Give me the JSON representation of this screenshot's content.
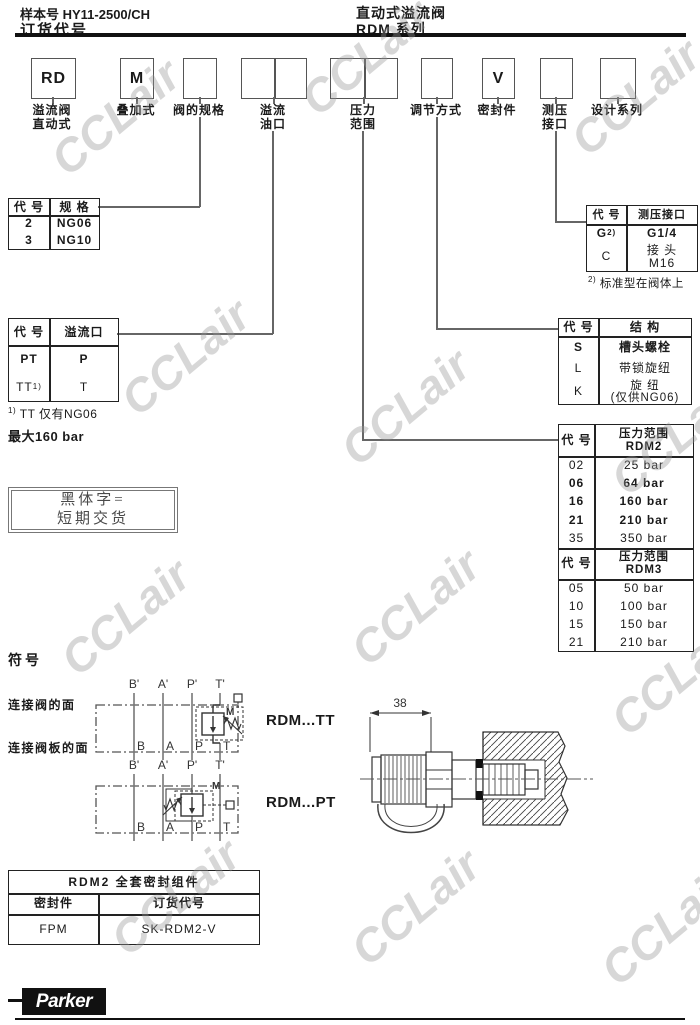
{
  "header": {
    "doc_no": "样本号 HY11-2500/CH",
    "title": "订货代号",
    "product": "直动式溢流阀",
    "series": "RDM  系列"
  },
  "watermark": {
    "text": "CCLair"
  },
  "order_code": {
    "items": [
      {
        "code": "RD",
        "line1": "溢流阀",
        "line2": "直动式"
      },
      {
        "code": "M",
        "line1": "叠加式",
        "line2": ""
      },
      {
        "code": "",
        "line1": "阀的规格",
        "line2": ""
      },
      {
        "code": "",
        "line1": "溢流",
        "line2": "油口"
      },
      {
        "code": "",
        "line1": "压力",
        "line2": "范围"
      },
      {
        "code": "",
        "line1": "调节方式",
        "line2": ""
      },
      {
        "code": "V",
        "line1": "密封件",
        "line2": ""
      },
      {
        "code": "",
        "line1": "测压",
        "line2": "接口"
      },
      {
        "code": "",
        "line1": "设计系列",
        "line2": ""
      }
    ]
  },
  "tables": {
    "size": {
      "h_code": "代 号",
      "h_val": "规 格",
      "rows": [
        {
          "code": "2",
          "val": "NG06"
        },
        {
          "code": "3",
          "val": "NG10"
        }
      ]
    },
    "port": {
      "h_code": "代 号",
      "h_val": "溢流口",
      "rows": [
        {
          "code": "PT",
          "sup": "",
          "val": "P"
        },
        {
          "code": "TT",
          "sup": "1)",
          "val": "T"
        }
      ],
      "fn_sup": "1)",
      "fn_text": "TT 仅有NG06",
      "note": "最大160 bar"
    },
    "gauge": {
      "h_code": "代 号",
      "h_val": "测压接口",
      "rows": [
        {
          "code": "G",
          "sup": "2)",
          "val": "G1/4",
          "val2": ""
        },
        {
          "code": "C",
          "sup": "",
          "val": "接 头",
          "val2": "M16"
        }
      ],
      "fn_sup": "2)",
      "fn_text": "标准型在阀体上"
    },
    "adjust": {
      "h_code": "代 号",
      "h_val": "结 构",
      "rows": [
        {
          "code": "S",
          "val": "槽头螺栓",
          "val2": ""
        },
        {
          "code": "L",
          "val": "带锁旋纽",
          "val2": ""
        },
        {
          "code": "K",
          "val": "旋 纽",
          "val2": "(仅供NG06)"
        }
      ]
    },
    "pressure2": {
      "h_code": "代 号",
      "h_val": "压力范围",
      "h_series": "RDM2",
      "rows": [
        {
          "code": "02",
          "val": "25 bar"
        },
        {
          "code": "06",
          "val": "64 bar"
        },
        {
          "code": "16",
          "val": "160 bar"
        },
        {
          "code": "21",
          "val": "210 bar"
        },
        {
          "code": "35",
          "val": "350 bar"
        }
      ]
    },
    "pressure3": {
      "h_code": "代 号",
      "h_val": "压力范围",
      "h_series": "RDM3",
      "rows": [
        {
          "code": "05",
          "val": "50 bar"
        },
        {
          "code": "10",
          "val": "100 bar"
        },
        {
          "code": "15",
          "val": "150 bar"
        },
        {
          "code": "21",
          "val": "210 bar"
        }
      ]
    },
    "seal": {
      "title": "RDM2  全套密封组件",
      "h_code": "密封件",
      "h_val": "订货代号",
      "rows": [
        {
          "code": "FPM",
          "val": "SK-RDM2-V"
        }
      ]
    }
  },
  "note_box": {
    "line1": "黑体字=",
    "line2": "短期交货"
  },
  "symbols": {
    "title": "符号",
    "label_valve_side": "连接阀的面",
    "label_plate_side": "连接阀板的面",
    "ports_top": [
      "B'",
      "A'",
      "P'",
      "T'"
    ],
    "ports_bottom": [
      "B",
      "A",
      "P",
      "T"
    ],
    "diagram1_name": "RDM...TT",
    "diagram2_name": "RDM...PT",
    "valve_letter": "M",
    "dimension": "38"
  },
  "footer": {
    "brand": "Parker"
  }
}
